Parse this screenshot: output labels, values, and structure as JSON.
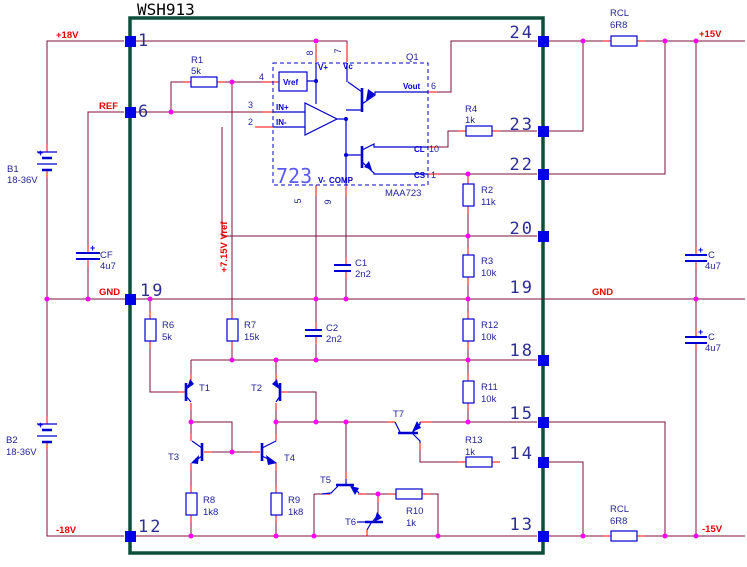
{
  "title": "WSH913",
  "nets": {
    "p18": "+18V",
    "ref": "REF",
    "gnd_l": "GND",
    "m18": "-18V",
    "p15": "+15V",
    "gnd_r": "GND",
    "m15": "-15V",
    "vref_rail": "+7.15V Vref"
  },
  "pins": {
    "l1": "1",
    "l6": "6",
    "l19": "19",
    "l12": "12",
    "r24": "24",
    "r23": "23",
    "r22": "22",
    "r20": "20",
    "r19": "19",
    "r18": "18",
    "r15": "15",
    "r14": "14",
    "r13": "13"
  },
  "resistors": {
    "r1": {
      "ref": "R1",
      "value": "5k"
    },
    "r2": {
      "ref": "R2",
      "value": "11k"
    },
    "r3": {
      "ref": "R3",
      "value": "10k"
    },
    "r4": {
      "ref": "R4",
      "value": "1k"
    },
    "r6": {
      "ref": "R6",
      "value": "5k"
    },
    "r7": {
      "ref": "R7",
      "value": "15k"
    },
    "r8": {
      "ref": "R8",
      "value": "1k8"
    },
    "r9": {
      "ref": "R9",
      "value": "1k8"
    },
    "r10": {
      "ref": "R10",
      "value": "1k"
    },
    "r11": {
      "ref": "R11",
      "value": "10k"
    },
    "r12": {
      "ref": "R12",
      "value": "10k"
    },
    "r13": {
      "ref": "R13",
      "value": "1k"
    },
    "rclt": {
      "ref": "RCL",
      "value": "6R8"
    },
    "rclb": {
      "ref": "RCL",
      "value": "6R8"
    }
  },
  "capacitors": {
    "cf": {
      "ref": "CF",
      "value": "4u7",
      "polarity": "+"
    },
    "ct": {
      "ref": "C",
      "value": "4u7",
      "polarity": "+"
    },
    "cb": {
      "ref": "C",
      "value": "4u7",
      "polarity": "+"
    },
    "c1": {
      "ref": "C1",
      "value": "2n2"
    },
    "c2": {
      "ref": "C2",
      "value": "2n2"
    }
  },
  "transistors": {
    "t1": "T1",
    "t2": "T2",
    "t3": "T3",
    "t4": "T4",
    "t5": "T5",
    "t6": "T6",
    "t7": "T7"
  },
  "batteries": {
    "b1": {
      "ref": "B1",
      "value": "18-36V",
      "polarity": "+"
    },
    "b2": {
      "ref": "B2",
      "value": "18-36V",
      "polarity": "+"
    }
  },
  "ic": {
    "designator": "Q1",
    "big_label": "723",
    "part": "MAA723",
    "blocks": {
      "vref": "Vref"
    },
    "pin_labels": {
      "vplus": "V+",
      "vc": "Vc",
      "inp": "IN+",
      "inn": "IN-",
      "vminus": "V-",
      "comp": "COMP",
      "vout": "Vout",
      "cl": "CL",
      "cs": "CS"
    },
    "pin_numbers": {
      "n8": "8",
      "n7": "7",
      "n4": "4",
      "n3": "3",
      "n2": "2",
      "n5": "5",
      "n9": "9",
      "n6": "6",
      "n10": "10",
      "n1": "1"
    }
  },
  "colors": {
    "wire": "#7d0f3d",
    "lead": "#fa0000",
    "component": "#0000d2",
    "junction": "#ff00ff",
    "pin_square": "#0000e6",
    "border": "#0d4f3a",
    "net_label": "#ee0000",
    "label": "#1f1f96"
  }
}
